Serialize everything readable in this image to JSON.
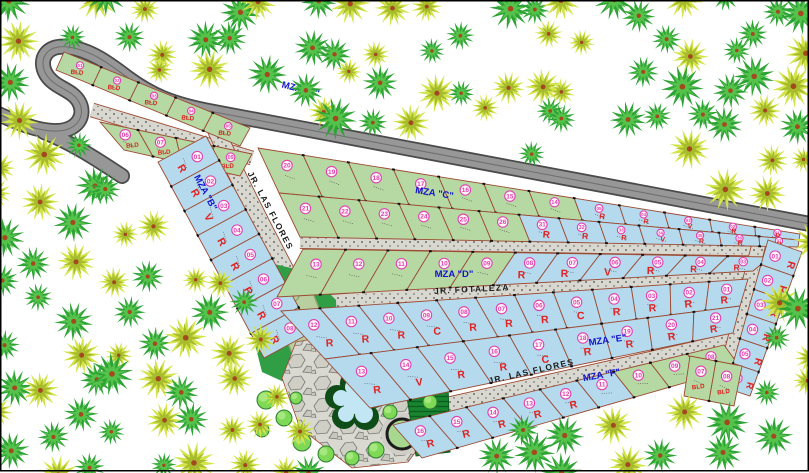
{
  "plan": {
    "drawing_type": "residential subdivision site plan",
    "streets": [
      {
        "id": "las-flores-upper",
        "name": "JR. LAS FLORES"
      },
      {
        "id": "fotaleza",
        "name": "JR. FOTALEZA"
      },
      {
        "id": "las-flores-lower",
        "name": "JR. LAS FLORES"
      }
    ],
    "manzanas": [
      {
        "id": "A",
        "label": "MZA \"A\""
      },
      {
        "id": "B",
        "label": "MZA \"B\""
      },
      {
        "id": "C",
        "label": "MZA \"C\""
      },
      {
        "id": "D",
        "label": "MZA \"D\""
      },
      {
        "id": "E",
        "label": "MZA \"E\""
      },
      {
        "id": "F",
        "label": "MZA \"F\""
      }
    ],
    "lot_letter_codes": [
      "R",
      "V",
      "C",
      "BLD"
    ],
    "blocks": {
      "A": {
        "rows": [
          [
            [
              "01",
              "BLD",
              "g"
            ],
            [
              "02",
              "BLD",
              "g"
            ],
            [
              "03",
              "BLD",
              "g"
            ],
            [
              "04",
              "BLD",
              "g"
            ],
            [
              "05",
              "BLD",
              "g"
            ]
          ],
          [
            [
              "06",
              "BLD",
              "g"
            ],
            [
              "07",
              "BLD",
              "g"
            ],
            [
              "08",
              "BLD",
              "g"
            ],
            [
              "09",
              "BLD",
              "g"
            ]
          ]
        ]
      },
      "B": {
        "rows": [
          [
            [
              "01",
              "R",
              "b"
            ],
            [
              "02",
              "R",
              "b"
            ],
            [
              "03",
              "V",
              "b"
            ],
            [
              "04",
              "R",
              "b"
            ],
            [
              "05",
              "R",
              "b"
            ],
            [
              "06",
              "R",
              "b"
            ],
            [
              "07",
              "R",
              "b"
            ],
            [
              "08",
              "R",
              "b"
            ]
          ]
        ]
      },
      "C": {
        "rows": [
          [
            [
              "20",
              "",
              "g"
            ],
            [
              "19",
              "",
              "g"
            ],
            [
              "18",
              "",
              "g"
            ],
            [
              "17",
              "",
              "g"
            ],
            [
              "16",
              "",
              "g"
            ],
            [
              "15",
              "",
              "g"
            ],
            [
              "14",
              "",
              "g"
            ],
            [
              "05",
              "R",
              "b"
            ],
            [
              "04",
              "R",
              "b"
            ],
            [
              "03",
              "V",
              "b"
            ],
            [
              "02",
              "R",
              "b"
            ],
            [
              "01",
              "R",
              "b"
            ]
          ],
          [
            [
              "21",
              "",
              "g"
            ],
            [
              "22",
              "",
              "g"
            ],
            [
              "23",
              "",
              "g"
            ],
            [
              "24",
              "",
              "g"
            ],
            [
              "25",
              "",
              "g"
            ],
            [
              "26",
              "",
              "g"
            ],
            [
              "31",
              "R",
              "b"
            ],
            [
              "32",
              "R",
              "b"
            ],
            [
              "33",
              "R",
              "b"
            ],
            [
              "34",
              "V",
              "b"
            ],
            [
              "35",
              "R",
              "b"
            ],
            [
              "36",
              "R",
              "b"
            ],
            [
              "37",
              "R",
              "b"
            ]
          ]
        ]
      },
      "D": {
        "rows": [
          [
            [
              "13",
              "",
              "g"
            ],
            [
              "12",
              "",
              "g"
            ],
            [
              "11",
              "",
              "g"
            ],
            [
              "10",
              "",
              "g"
            ],
            [
              "09",
              "",
              "g"
            ],
            [
              "08",
              "R",
              "b"
            ],
            [
              "07",
              "R",
              "b"
            ],
            [
              "06",
              "V",
              "b"
            ],
            [
              "05",
              "R",
              "b"
            ],
            [
              "04",
              "R",
              "b"
            ],
            [
              "03",
              "R",
              "b"
            ]
          ]
        ]
      },
      "E": {
        "rows": [
          [
            [
              "12",
              "R",
              "b"
            ],
            [
              "11",
              "R",
              "b"
            ],
            [
              "10",
              "R",
              "b"
            ],
            [
              "09",
              "C",
              "b"
            ],
            [
              "08",
              "R",
              "b"
            ],
            [
              "07",
              "R",
              "b"
            ],
            [
              "06",
              "R",
              "b"
            ],
            [
              "05",
              "C",
              "b"
            ],
            [
              "04",
              "R",
              "b"
            ],
            [
              "03",
              "R",
              "b"
            ],
            [
              "02",
              "R",
              "b"
            ],
            [
              "01",
              "R",
              "b"
            ]
          ],
          [
            [
              "13",
              "R",
              "b"
            ],
            [
              "14",
              "V",
              "b"
            ],
            [
              "15",
              "R",
              "b"
            ],
            [
              "16",
              "R",
              "b"
            ],
            [
              "17",
              "C",
              "b"
            ],
            [
              "18",
              "R",
              "b"
            ],
            [
              "19",
              "R",
              "b"
            ],
            [
              "20",
              "R",
              "b"
            ],
            [
              "21",
              "R",
              "b"
            ]
          ]
        ]
      },
      "F": {
        "rows": [
          [
            [
              "16",
              "R",
              "b"
            ],
            [
              "15",
              "R",
              "b"
            ],
            [
              "14",
              "R",
              "b"
            ],
            [
              "13",
              "R",
              "b"
            ],
            [
              "12",
              "R",
              "b"
            ],
            [
              "11",
              "",
              "b"
            ],
            [
              "10",
              "",
              "g"
            ],
            [
              "09",
              "",
              "g"
            ],
            [
              "08",
              "BLD",
              "g"
            ]
          ]
        ]
      },
      "G": {
        "rows": [
          [
            [
              "01",
              "R",
              "b"
            ],
            [
              "02",
              "R",
              "b"
            ],
            [
              "03",
              "R",
              "b"
            ],
            [
              "04",
              "R",
              "b"
            ],
            [
              "05",
              "R",
              "b"
            ],
            [
              "06",
              "R",
              "b"
            ]
          ]
        ]
      },
      "H": {
        "rows": [
          [
            [
              "07",
              "BLD",
              "g"
            ],
            [
              "08",
              "BLD",
              "g"
            ]
          ]
        ]
      }
    }
  },
  "colors": {
    "lot_green": "#b6d8a2",
    "lot_blue": "#b5daee",
    "lot_line": "#9c4a32",
    "road_fill": "#979797",
    "road_casing": "#4a4a4a",
    "street_fill": "#d8d8d0",
    "number_badge": "#e040b0",
    "letter_red": "#e02222",
    "mza_blue": "#1414cc",
    "park_green": "#2f9e44",
    "pond_water": "#c3e6f5",
    "pond_rim": "#0e4d18",
    "palm_green": "#2ea335",
    "palm_green_inner": "#55c24b",
    "palm_yellow": "#d3e448",
    "palm_yellow_inner": "#a7bc2d",
    "palm_trunk": "#a4481d"
  },
  "forest": {
    "types": [
      "palm-green",
      "palm-yellow"
    ]
  }
}
